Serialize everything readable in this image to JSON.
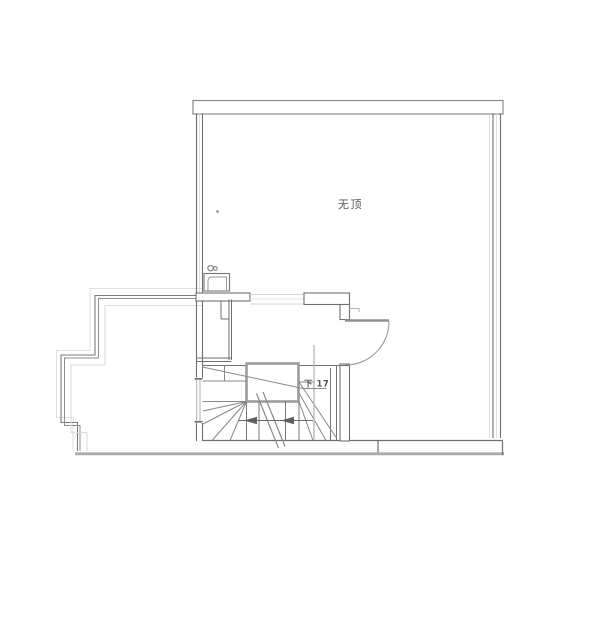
{
  "labels": {
    "room": "无顶",
    "stair": "下 17"
  },
  "colors": {
    "wall_dark": "#6f6f6f",
    "wall_medium": "#8f8f8f",
    "landing_border": "#9c9c9c",
    "light_line": "#d9d9d9",
    "ground_band": "#ababab",
    "label_text": "#555555"
  }
}
